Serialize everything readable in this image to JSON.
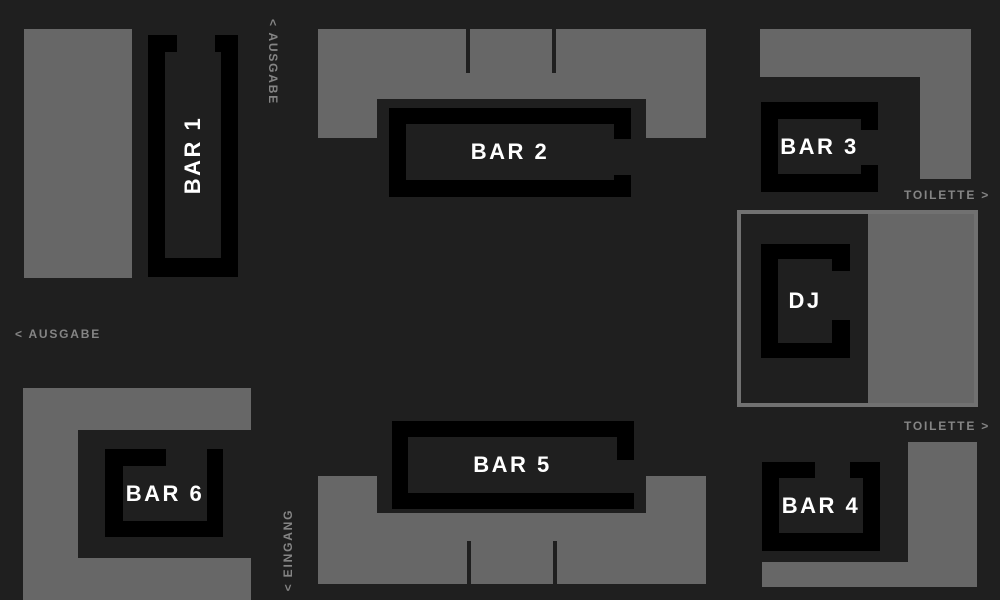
{
  "canvas": {
    "width": 1000,
    "height": 600
  },
  "colors": {
    "background": "#1f1f1f",
    "area_gray": "#676767",
    "bar_black": "#000000",
    "bar_inner": "#1f1f1f",
    "bar_label_white": "#ffffff",
    "sign_gray": "#858585",
    "dj_frame_stroke": "#717171"
  },
  "areas": [
    {
      "name": "area-top-left",
      "rects": [
        [
          24,
          29,
          108,
          249
        ]
      ],
      "cuts": []
    },
    {
      "name": "area-top-center",
      "rects": [
        [
          318,
          29,
          388,
          109
        ]
      ],
      "cuts": [
        [
          377,
          99,
          269,
          39
        ],
        [
          465.5,
          29,
          4.5,
          44
        ],
        [
          551.5,
          29,
          4.5,
          44
        ]
      ]
    },
    {
      "name": "area-top-right",
      "rects": [
        [
          760,
          29,
          211,
          48
        ],
        [
          920,
          77,
          51,
          102
        ]
      ],
      "cuts": []
    },
    {
      "name": "area-bottom-right",
      "rects": [
        [
          908,
          442,
          69,
          145
        ],
        [
          762,
          562,
          215,
          25
        ]
      ],
      "cuts": []
    },
    {
      "name": "area-bottom-center",
      "rects": [
        [
          318,
          476,
          388,
          108
        ]
      ],
      "cuts": [
        [
          377,
          476,
          269,
          37
        ],
        [
          466.5,
          541,
          4.5,
          43
        ],
        [
          552.5,
          541,
          4.5,
          43
        ]
      ]
    },
    {
      "name": "area-bottom-left",
      "rects": [
        [
          23,
          388,
          228,
          212
        ]
      ],
      "cuts": [
        [
          78,
          430,
          173,
          128
        ]
      ]
    }
  ],
  "dj_zone": {
    "frame": [
      737,
      210,
      241,
      197
    ],
    "floor": [
      868,
      214,
      106,
      189
    ]
  },
  "bars": [
    {
      "id": "bar-1",
      "label": "BAR 1",
      "outer": [
        148,
        35,
        90,
        242
      ],
      "inner": [
        165,
        52,
        56,
        206
      ],
      "gap": [
        177,
        35,
        38,
        17
      ],
      "label_rotation": -90
    },
    {
      "id": "bar-2",
      "label": "BAR 2",
      "outer": [
        389,
        108,
        242,
        89
      ],
      "inner": [
        406,
        124,
        208,
        56
      ],
      "gap": [
        614,
        139,
        17,
        36
      ],
      "label_rotation": 0
    },
    {
      "id": "bar-3",
      "label": "BAR 3",
      "outer": [
        761,
        102,
        117,
        90
      ],
      "inner": [
        778,
        119,
        83,
        55
      ],
      "gap": [
        861,
        130,
        17,
        35
      ],
      "label_rotation": 0
    },
    {
      "id": "dj-booth",
      "label": "DJ",
      "outer": [
        761,
        244,
        89,
        114
      ],
      "inner": [
        778,
        259,
        54,
        84
      ],
      "gap": [
        832,
        271,
        18,
        49
      ],
      "label_rotation": 0
    },
    {
      "id": "bar-4",
      "label": "BAR 4",
      "outer": [
        762,
        462,
        118,
        89
      ],
      "inner": [
        779,
        478,
        84,
        55
      ],
      "gap": [
        815,
        462,
        35,
        16
      ],
      "label_rotation": 0
    },
    {
      "id": "bar-5",
      "label": "BAR 5",
      "outer": [
        392,
        421,
        242,
        88
      ],
      "inner": [
        408,
        437,
        209,
        56
      ],
      "gap": [
        617,
        460,
        17,
        33
      ],
      "label_rotation": 0
    },
    {
      "id": "bar-6",
      "label": "BAR 6",
      "outer": [
        105,
        449,
        118,
        88
      ],
      "inner": [
        123,
        466,
        84,
        55
      ],
      "gap": [
        166,
        449,
        41,
        17
      ],
      "label_rotation": 0
    }
  ],
  "signs": [
    {
      "id": "sign-ausgabe-top",
      "text": "< AUSGABE",
      "x": 273,
      "y": 62,
      "rotation": 90
    },
    {
      "id": "sign-ausgabe-left",
      "text": "< AUSGABE",
      "x": 58,
      "y": 334,
      "rotation": 0
    },
    {
      "id": "sign-toilette-upper",
      "text": "TOILETTE >",
      "x": 947,
      "y": 195,
      "rotation": 0
    },
    {
      "id": "sign-toilette-lower",
      "text": "TOILETTE >",
      "x": 947,
      "y": 426,
      "rotation": 0
    },
    {
      "id": "sign-eingang",
      "text": "< EINGANG",
      "x": 288,
      "y": 550,
      "rotation": -90
    }
  ]
}
